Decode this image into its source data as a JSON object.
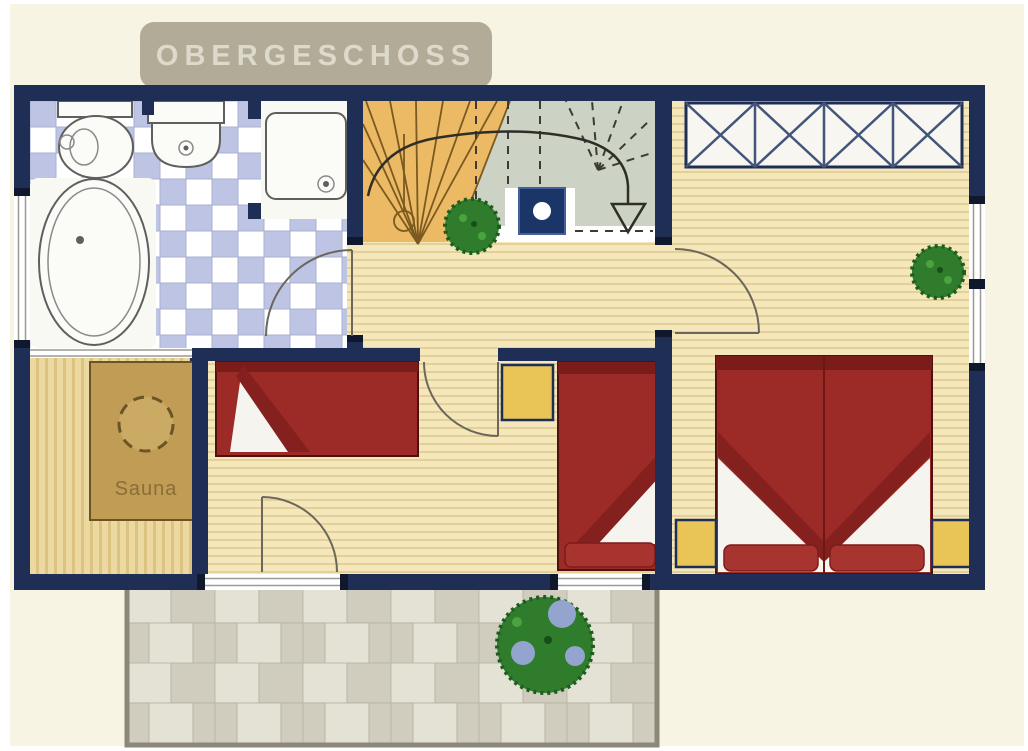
{
  "banner": {
    "label": "OBERGESCHOSS"
  },
  "rooms": {
    "sauna_label": "Sauna"
  },
  "icons": [
    "toilet-icon",
    "sink-icon",
    "shower-icon",
    "bathtub-icon",
    "winder-stairs-icon",
    "stair-direction-arrow-icon",
    "flue-icon",
    "wardrobe-icon",
    "single-bed-icon",
    "double-bed-icon",
    "nightstand-icon",
    "sauna-heater-icon",
    "plant-icon",
    "balcony-bush-icon",
    "window-icon",
    "door-swing-icon"
  ],
  "colors": {
    "bg": "#f8f4e4",
    "wall": "#1f2e55",
    "wallcap": "#10182e",
    "banner": "#b2ab97",
    "bannerText": "#dedacb",
    "tileBlue": "#bdc4e4",
    "tileWhite": "#ffffff",
    "tileGrout": "#a9b0d0",
    "woodLight": "#f4e7bb",
    "woodLine": "#e4d096",
    "saunaFloor": "#ecd9a2",
    "saunaFloorLine": "#dcc382",
    "saunaCabin": "#c19c55",
    "saunaCabin2": "#cbaa64",
    "saunaText": "#8a6e38",
    "stairOrange": "#ecb964",
    "stairGray": "#ccd3c5",
    "bedRed": "#9c2a26",
    "bedDark": "#7a1c1a",
    "bedFold": "#84201e",
    "pillow": "#a83430",
    "nightstand": "#e9c558",
    "paver1": "#e4e2d5",
    "paver2": "#d0cdbf",
    "paverGrout": "#b3b0a1",
    "balconyBorder": "#8b887a",
    "green": "#2f7c2c",
    "greenDark": "#1d5c1e",
    "berry": "#93a4cf",
    "flue": "#1c3568"
  }
}
